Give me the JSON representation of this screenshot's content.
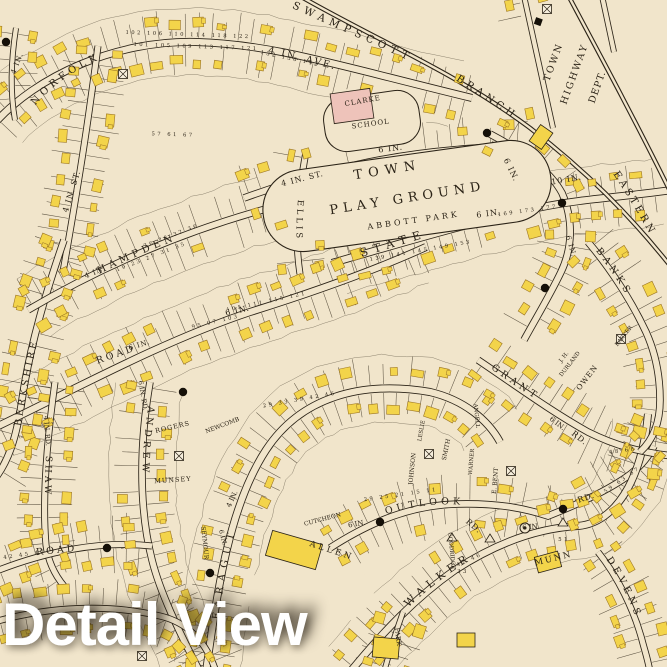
{
  "title": "Detail View",
  "map": {
    "streets": {
      "norfolk": "NORFOLK",
      "swampscott": "SWAMPSCOTT",
      "branch": "BRANCH",
      "eastern": "EASTERN",
      "fourth_ave": "4 IN. AVE.",
      "st4_upper": "4 IN. ST.",
      "st4_school": "4 IN. ST.",
      "ellis": "ELLIS",
      "state": "STATE",
      "berkshire": "BERKSHIRE",
      "hampden": "HAMPDEN",
      "road_mid": "ROAD",
      "road_bottom": "ROAD",
      "banks": "BANKS",
      "grant": "GRANT",
      "grant_rd": "RD.",
      "owen": "OWEN",
      "andrew": "ANDREW",
      "faragut": "FARAGUT",
      "outlook": "OUTLOOK",
      "outlook_rd": "RD.",
      "rd_east": "RD.",
      "walker": "WALKER",
      "devens": "DEVENS",
      "shaw": "SHAW",
      "park": "PARK"
    },
    "places": {
      "playground1": "TOWN",
      "playground2": "PLAY GROUND",
      "abbott": "ABBOTT PARK",
      "clarke": "CLARKE",
      "school": "SCHOOL",
      "town_highway": [
        "TOWN",
        "HIGHWAY",
        "DEPT."
      ],
      "allen": "ALLEN",
      "munn": "MUNN"
    },
    "properties": {
      "rogers": "ROGERS",
      "munsey": "MUNSEY",
      "newcomb": "NEWCOMB",
      "cutcheon": "CUTCHEON",
      "johnson": "JOHNSON",
      "leslie": "LESLIE",
      "smith": "SMITH",
      "e_bent": "E. BENT",
      "warner": "WARNER",
      "goodridge": "GOODRIDGE",
      "seymour": "SEYMOUR",
      "angell": "ANGELL",
      "durland1": "J. H.",
      "durland2": "DURLAND",
      "barker": "BARKER"
    },
    "pipes": {
      "p4": "4 IN.",
      "p6": "6 IN.",
      "p10": "10 IN.",
      "p6rd": "6 IN. RD.",
      "p4rd": "4 IN. RD."
    },
    "lot_numbers": {
      "norfolk_s": "102 106 110 114 118 122",
      "norfolk_n": "101 105 109 113 117 121",
      "ave": "132 136 142",
      "cross": "57 61 67",
      "hampden_n": "26 28 32 36",
      "hampden_s": "19 23 27 31 35",
      "state_w": "139 141 145 149 153",
      "state_e": "169 173 177",
      "mid_n": "105 111 115 121",
      "mid_s": "95 97 103",
      "faragut": "29 33 39 42 46",
      "outlook": "29 25 21 15 11",
      "walker_a": "42 46",
      "walker_b": "59 63 67",
      "walker_c": "51",
      "walker_d": "33",
      "shaw": "42 45 47",
      "grant": "48 68"
    },
    "colors": {
      "paper": "#f1e5cb",
      "ink": "#2b2317",
      "building": "#f3d44a",
      "building_edge": "#9c7524",
      "school": "#eec3ba",
      "title": "#ffffff"
    }
  }
}
